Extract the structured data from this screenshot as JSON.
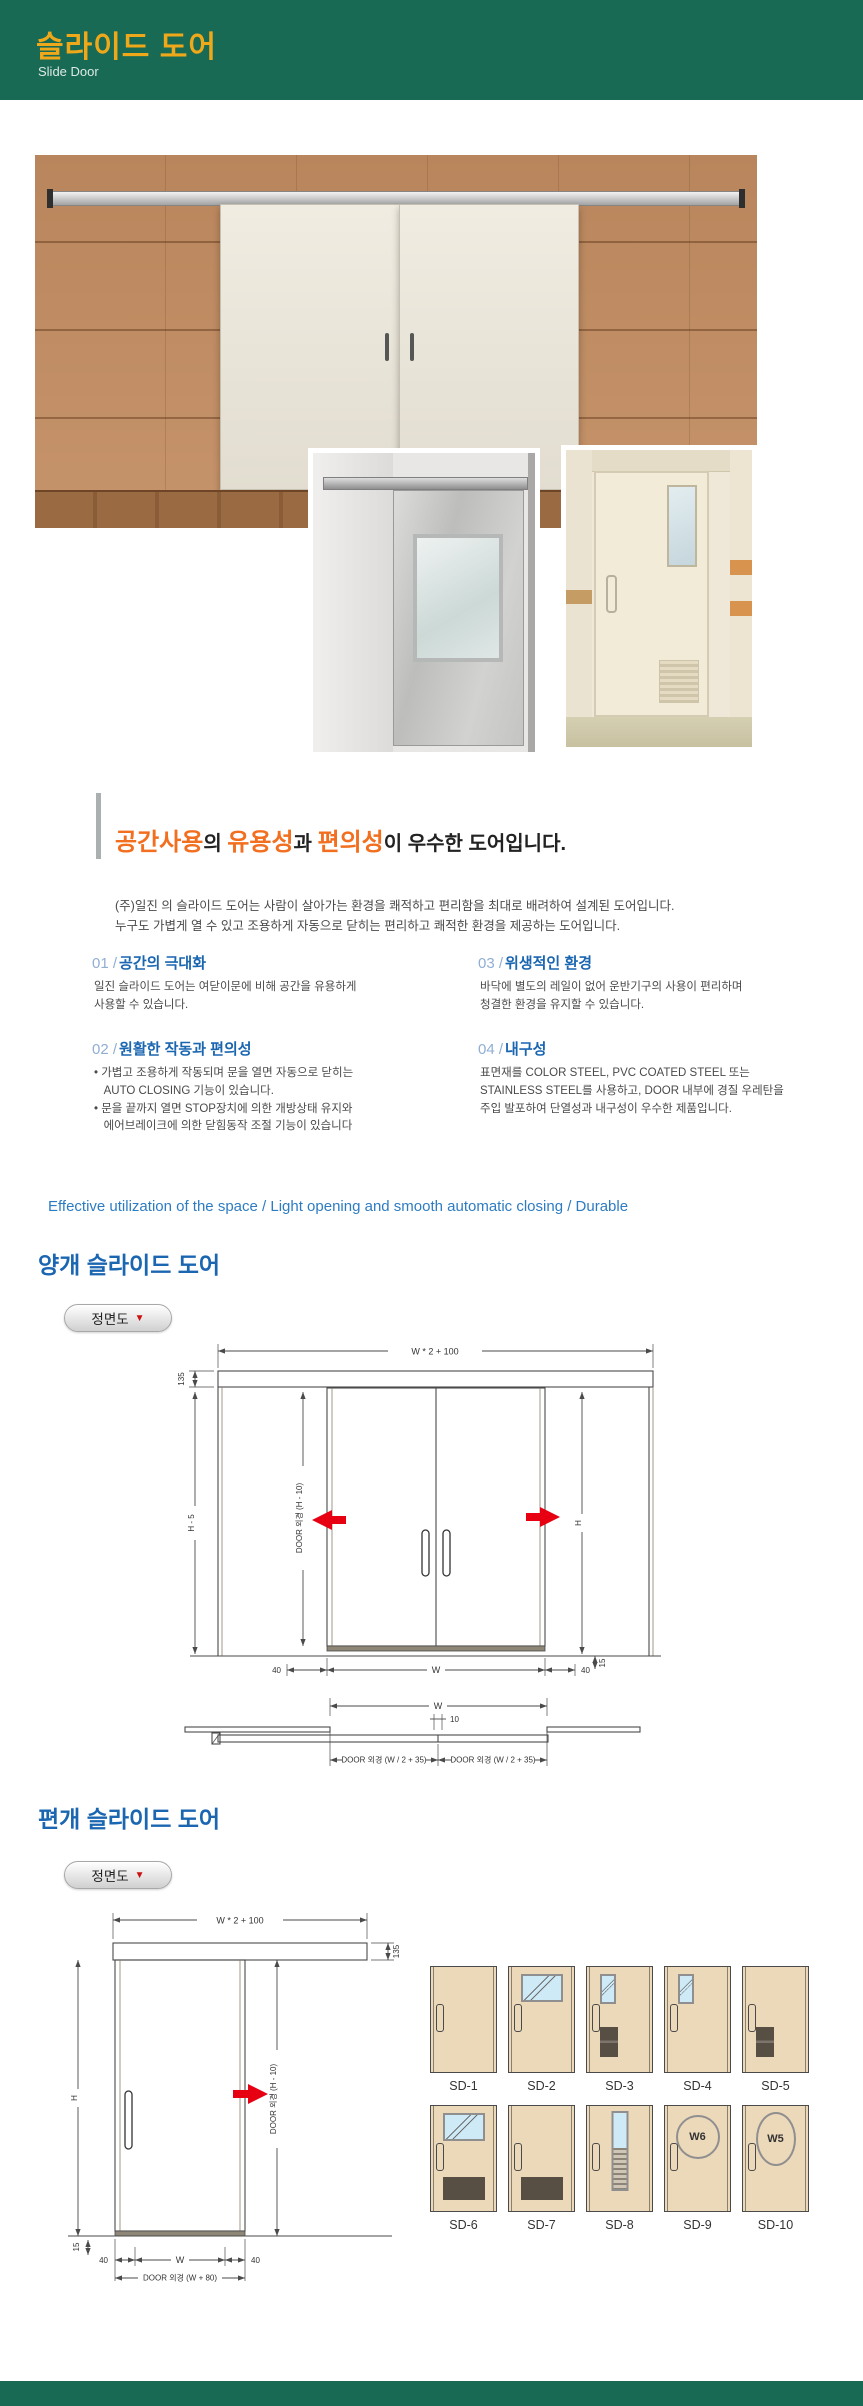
{
  "header": {
    "title": "슬라이드 도어",
    "subtitle": "Slide Door"
  },
  "intro": {
    "heading": [
      {
        "text": "공간사용"
      },
      {
        "text": "의 "
      },
      {
        "text": "유용성"
      },
      {
        "text": "과 "
      },
      {
        "text": "편의성"
      },
      {
        "text": "이 우수한 도어입니다."
      }
    ],
    "para": "(주)일진 의 슬라이드 도어는 사람이 살아가는 환경을 쾌적하고 편리함을 최대로 배려하여 설계된 도어입니다.\n누구도 가볍게 열 수 있고 조용하게 자동으로 닫히는 편리하고 쾌적한 환경을 제공하는 도어입니다.",
    "features": [
      {
        "num": "01 /",
        "title": "공간의 극대화",
        "body": "일진 슬라이드 도어는 여닫이문에 비해 공간을 유용하게\n사용할 수 있습니다."
      },
      {
        "num": "02 /",
        "title": "원활한 작동과 편의성",
        "body": "• 가볍고 조용하게 작동되며 문을 열면 자동으로 닫히는\n   AUTO CLOSING 기능이 있습니다.\n• 문을 끝까지 열면 STOP장치에 의한 개방상태 유지와\n   에어브레이크에 의한 닫힘동작 조절 기능이 있습니다"
      },
      {
        "num": "03 /",
        "title": "위생적인 환경",
        "body": "바닥에 별도의 레일이 없어 운반기구의 사용이 편리하며\n청결한 환경을 유지할 수 있습니다."
      },
      {
        "num": "04 /",
        "title": "내구성",
        "body": "표면재를 COLOR STEEL, PVC COATED STEEL 또는\nSTAINLESS STEEL를 사용하고, DOOR 내부에 경질 우레탄을\n주입 발포하여 단열성과 내구성이 우수한 제품입니다."
      }
    ]
  },
  "tagline": "Effective utilization of the space / Light opening and smooth automatic closing / Durable",
  "section_double": {
    "title": "양개 슬라이드 도어",
    "view_label": "정면도",
    "view_arrow": "▼"
  },
  "section_single": {
    "title": "편개 슬라이드 도어",
    "view_label": "정면도",
    "view_arrow": "▼"
  },
  "drawing_double": {
    "dim_top": "W * 2 + 100",
    "dim_track": "135",
    "dim_left": "H - 5",
    "dim_door_h": "DOOR 외경 (H - 10)",
    "dim_right": "H",
    "dim_40_left": "40",
    "dim_w": "W",
    "dim_40_right": "40",
    "dim_15": "15",
    "plan_w": "W",
    "plan_gap": "10",
    "plan_left": "DOOR 외경 (W / 2 + 35)",
    "plan_right": "DOOR 외경 (W / 2 + 35)"
  },
  "drawing_single": {
    "dim_top": "W * 2 + 100",
    "dim_track": "135",
    "dim_left": "H",
    "dim_door_h": "DOOR 외경 (H - 10)",
    "dim_15": "15",
    "dim_40_left": "40",
    "dim_w": "W",
    "dim_40_right": "40",
    "dim_door_w": "DOOR 외경 (W + 80)"
  },
  "door_types": {
    "items": [
      {
        "label": "SD-1"
      },
      {
        "label": "SD-2"
      },
      {
        "label": "SD-3"
      },
      {
        "label": "SD-4"
      },
      {
        "label": "SD-5"
      },
      {
        "label": "SD-6"
      },
      {
        "label": "SD-7"
      },
      {
        "label": "SD-8"
      },
      {
        "label": "SD-9",
        "window_label": "W6"
      },
      {
        "label": "SD-10",
        "window_label": "W5"
      }
    ]
  },
  "colors": {
    "header_bg": "#186a55",
    "header_title": "#f0a81b",
    "accent_orange": "#f26f1f",
    "feature_blue": "#1b66b1",
    "tagline_blue": "#2d7cc2",
    "arrow_red": "#e60012",
    "door_beige": "#ecd9ba"
  }
}
